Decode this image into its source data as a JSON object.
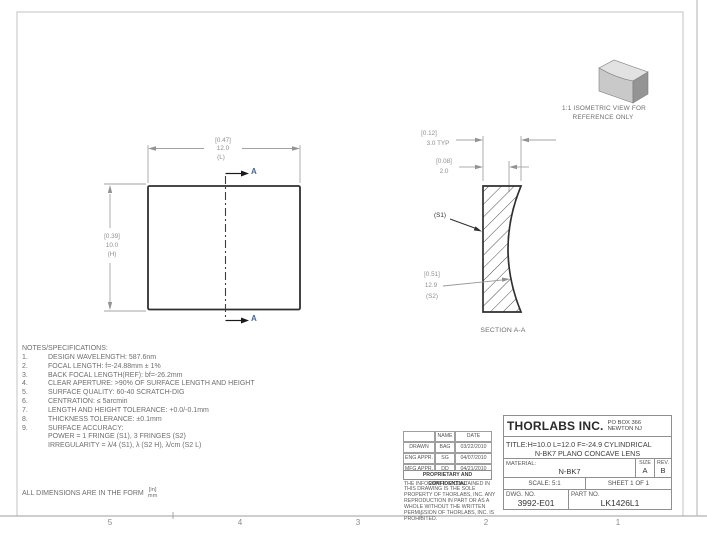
{
  "page": {
    "zones": [
      "5",
      "4",
      "3",
      "2",
      "1"
    ],
    "units_note": "ALL DIMENSIONS ARE IN THE FORM",
    "units_numerator": "[in]",
    "units_denominator": "mm"
  },
  "iso_view": {
    "caption_line1": "1:1 ISOMETRIC VIEW FOR",
    "caption_line2": "REFERENCE ONLY"
  },
  "front_view": {
    "section_letter": "A",
    "width_dim": {
      "bracket": "[0.47]",
      "value": "12.0",
      "suffix": "(L)"
    },
    "height_dim": {
      "bracket": "[0.39]",
      "value": "10.0",
      "suffix": "(H)"
    }
  },
  "section_view": {
    "caption": "SECTION A-A",
    "edge_dim": {
      "bracket": "[0.12]",
      "value": "3.0  TYP"
    },
    "center_dim": {
      "bracket": "[0.08]",
      "value": "2.0"
    },
    "s1_label": "(S1)",
    "s2_dim": {
      "bracket": "[0.51]",
      "value": "12.9",
      "suffix": "(S2)"
    }
  },
  "notes": {
    "title": "NOTES/SPECIFICATIONS:",
    "items": [
      {
        "num": "1.",
        "text": "DESIGN WAVELENGTH: 587.6nm"
      },
      {
        "num": "2.",
        "text": "FOCAL LENGTH: f=-24.88mm ± 1%"
      },
      {
        "num": "3.",
        "text": "BACK FOCAL LENGTH(REF): bf=-26.2mm"
      },
      {
        "num": "4.",
        "text": "CLEAR APERTURE: >90% OF SURFACE LENGTH AND HEIGHT"
      },
      {
        "num": "5.",
        "text": "SURFACE QUALITY: 60-40 SCRATCH-DIG"
      },
      {
        "num": "6.",
        "text": "CENTRATION: ≤ 5arcmin"
      },
      {
        "num": "7.",
        "text": "LENGTH AND HEIGHT TOLERANCE: +0.0/-0.1mm"
      },
      {
        "num": "8.",
        "text": "THICKNESS TOLERANCE: ±0.1mm"
      },
      {
        "num": "9.",
        "text": "SURFACE ACCURACY:"
      },
      {
        "num": "",
        "text": "POWER = 1 FRINGE (S1), 3 FRINGES (S2)"
      },
      {
        "num": "",
        "text": "IRREGULARITY = λ/4 (S1), λ (S2 H), λ/cm (S2 L)"
      }
    ]
  },
  "title_block": {
    "company": "THORLABS INC.",
    "address_line1": "PO BOX 366",
    "address_line2": "NEWTON NJ",
    "title_line1": "TITLE:H=10.0 L=12.0 F=-24.9 CYLINDRICAL",
    "title_line2": "N-BK7 PLANO CONCAVE LENS",
    "material_label": "MATERIAL:",
    "material_value": "N-BK7",
    "size_label": "SIZE",
    "size_value": "A",
    "rev_label": "REV.",
    "rev_value": "B",
    "scale": "SCALE: 5:1",
    "sheet": "SHEET 1 OF 1",
    "dwg_label": "DWG.  NO.",
    "dwg_value": "3992-E01",
    "part_label": "PART  NO.",
    "part_value": "LK1426L1",
    "approvals": {
      "name_header": "NAME",
      "date_header": "DATE",
      "rows": [
        {
          "role": "DRAWN",
          "name": "BAG",
          "date": "03/22/2010"
        },
        {
          "role": "ENG APPR.",
          "name": "SG",
          "date": "04/07/2010"
        },
        {
          "role": "MFG APPR.",
          "name": "DD",
          "date": "04/21/2010"
        }
      ]
    },
    "proprietary_header": "PROPRIETARY AND CONFIDENTIAL",
    "proprietary_text": "THE INFORMATION CONTAINED IN THIS DRAWING IS THE SOLE PROPERTY OF THORLABS, INC.  ANY REPRODUCTION IN PART OR AS A WHOLE WITHOUT THE WRITTEN PERMISSION OF THORLABS, INC. IS PROHIBITED."
  }
}
